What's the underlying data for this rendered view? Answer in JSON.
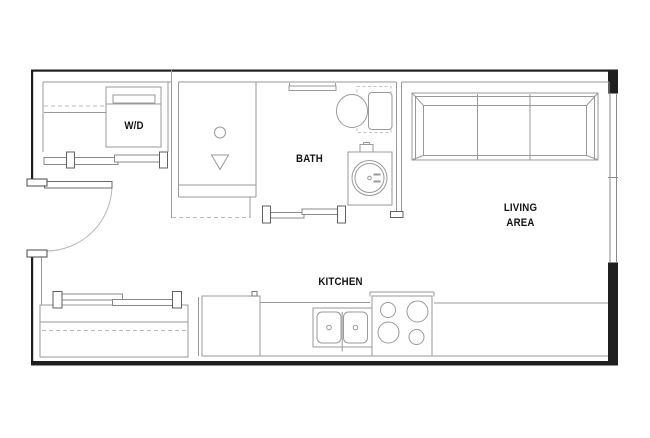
{
  "canvas": {
    "width": 650,
    "height": 438,
    "background": "#ffffff"
  },
  "palette": {
    "exterior_wall": "#1f1f1f",
    "fixture_line": "#9a9a9a",
    "jamb_line": "#616161",
    "dashed_line": "#bcbcbc",
    "door_arc": "#b5b5b5",
    "label_text": "#131313",
    "page_border": "#e3e3e3"
  },
  "rooms": [
    {
      "id": "wd-closet",
      "label": "W/D"
    },
    {
      "id": "bath",
      "label": "BATH"
    },
    {
      "id": "living-area",
      "label": "LIVING AREA"
    },
    {
      "id": "kitchen",
      "label": "KITCHEN"
    }
  ],
  "fixtures": [
    "washer-dryer-unit",
    "closet-rod-and-shelf",
    "wd-closet-sliding-doors",
    "shower-stall",
    "shower-drain-circle",
    "shower-drain-triangle",
    "wall-niche",
    "toilet",
    "toilet-clearance-dashes",
    "vanity-round-sink",
    "bath-sliding-door",
    "entry-swing-door",
    "entry-closet-sliding-doors",
    "entry-closet-rod-and-shelf",
    "sofa-three-seat",
    "window-right-wall",
    "refrigerator",
    "kitchen-counter",
    "double-basin-sink",
    "cooktop-four-burners"
  ]
}
